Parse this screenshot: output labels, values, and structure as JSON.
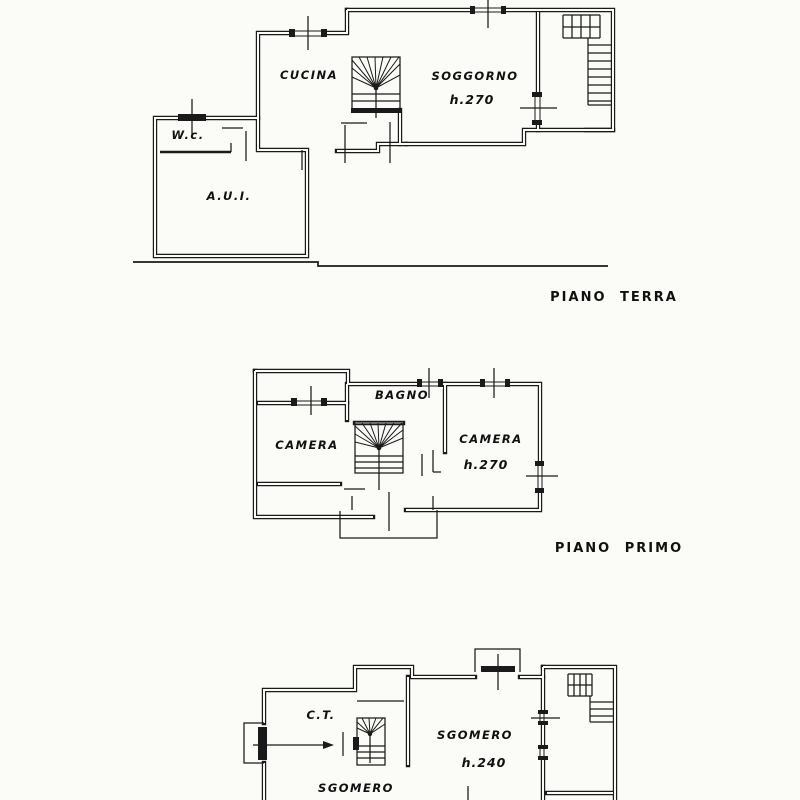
{
  "drawing": {
    "paper_color": "#fbfbf8",
    "ink_color": "#1a1a1a",
    "floors": [
      {
        "name": "ground-floor",
        "caption": "PIANO TERRA",
        "labels": {
          "kitchen": "CUCINA",
          "living_room": "SOGGORNO",
          "living_room_height": "h.270",
          "wc": "W.c.",
          "annex": "A.U.I."
        }
      },
      {
        "name": "first-floor",
        "caption": "PIANO PRIMO",
        "labels": {
          "bathroom": "BAGNO",
          "bedroom_left": "CAMERA",
          "bedroom_right": "CAMERA",
          "bedroom_right_height": "h.270"
        }
      },
      {
        "name": "basement-partial",
        "labels": {
          "boiler_room": "C.T.",
          "storage_main": "SGOMERO",
          "storage_main_height": "h.240",
          "storage_left": "SGOMERO"
        }
      }
    ]
  }
}
